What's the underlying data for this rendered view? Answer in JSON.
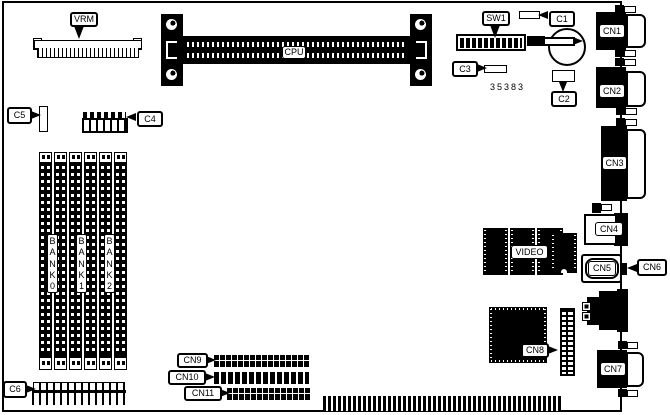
{
  "board": {
    "part_number": "35383",
    "components": {
      "vrm": "VRM",
      "cpu": "CPU",
      "sw1": "SW1",
      "c1": "C1",
      "c2": "C2",
      "c3": "C3",
      "c4": "C4",
      "c5": "C5",
      "c6": "C6",
      "cn1": "CN1",
      "cn2": "CN2",
      "cn3": "CN3",
      "cn4": "CN4",
      "cn5": "CN5",
      "cn6": "CN6",
      "cn7": "CN7",
      "cn8": "CN8",
      "cn9": "CN9",
      "cn10": "CN10",
      "cn11": "CN11",
      "video": "VIDEO"
    },
    "memory_banks": [
      {
        "label": "BANK0"
      },
      {
        "label": "BANK1"
      },
      {
        "label": "BANK2"
      }
    ]
  }
}
